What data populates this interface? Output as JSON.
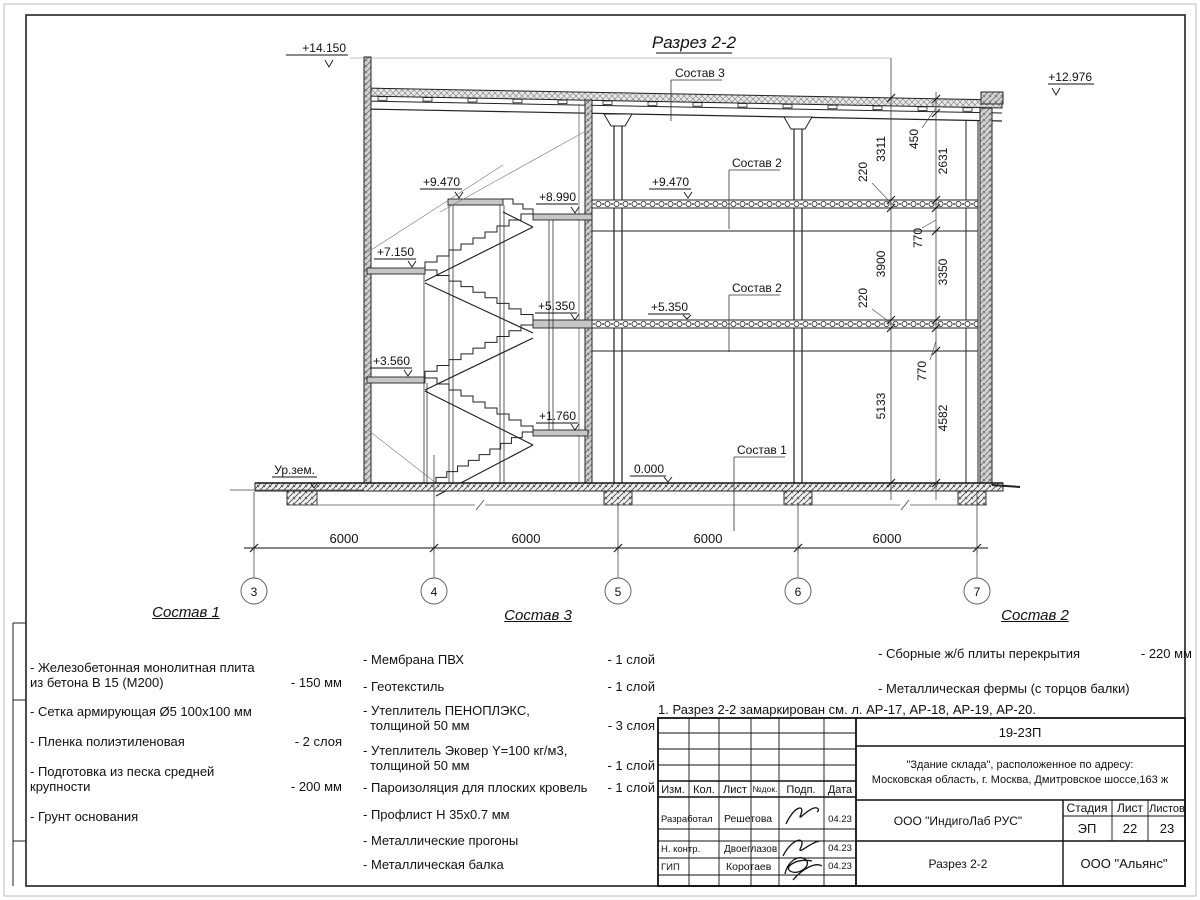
{
  "drawing": {
    "title": "Разрез 2-2",
    "callout_roof": "Состав 3",
    "callout_floor_upper": "Состав 2",
    "callout_floor_lower": "Состав 2",
    "callout_slab": "Состав 1",
    "elev_top_left": "+14.150",
    "elev_top_right": "+12.976",
    "elev_stair_1": "+9.470",
    "elev_stair_2": "+8.990",
    "elev_stair_3": "+7.150",
    "elev_stair_4": "+5.350",
    "elev_stair_5": "+3.560",
    "elev_stair_6": "+1.760",
    "elev_hall_upper": "+9.470",
    "elev_hall_lower": "+5.350",
    "elev_zero": "0.000",
    "elev_ground": "Ур.зем."
  },
  "dims": {
    "inner": [
      "3311",
      "220",
      "3900",
      "220",
      "5133"
    ],
    "outer": [
      "450",
      "2631",
      "770",
      "3350",
      "770",
      "4582"
    ],
    "bottom": [
      "6000",
      "6000",
      "6000",
      "6000"
    ],
    "axes": [
      "3",
      "4",
      "5",
      "6",
      "7"
    ]
  },
  "legends": {
    "c1": {
      "title": "Состав 1",
      "items": [
        {
          "l1": "- Железобетонная  монолитная плита",
          "l2": "из бетона В 15 (М200)",
          "v": "- 150 мм"
        },
        {
          "l1": "- Сетка армирующая Ø5 100x100 мм",
          "l2": "",
          "v": ""
        },
        {
          "l1": "- Пленка полиэтиленовая",
          "l2": "",
          "v": "- 2 слоя"
        },
        {
          "l1": "- Подготовка из песка средней",
          "l2": "крупности",
          "v": "- 200 мм"
        },
        {
          "l1": "- Грунт основания",
          "l2": "",
          "v": ""
        }
      ]
    },
    "c3": {
      "title": "Состав 3",
      "items": [
        {
          "l1": "- Мембрана ПВХ",
          "l2": "",
          "v": "- 1 слой"
        },
        {
          "l1": "- Геотекстиль",
          "l2": "",
          "v": "- 1 слой"
        },
        {
          "l1": "- Утеплитель ПЕНОПЛЭКС,",
          "l2": "толщиной 50 мм",
          "v": "- 3 слоя"
        },
        {
          "l1": "- Утеплитель Эковер Y=100 кг/м3,",
          "l2": "толщиной 50 мм",
          "v": "- 1 слой"
        },
        {
          "l1": "- Пароизоляция для плоских кровель",
          "l2": "",
          "v": "- 1 слой"
        },
        {
          "l1": "- Профлист Н 35х0.7 мм",
          "l2": "",
          "v": ""
        },
        {
          "l1": "- Металлические прогоны",
          "l2": "",
          "v": ""
        },
        {
          "l1": "- Металлическая балка",
          "l2": "",
          "v": ""
        }
      ]
    },
    "c2": {
      "title": "Состав 2",
      "items": [
        {
          "l1": "- Сборные ж/б плиты перекрытия",
          "l2": "",
          "v": "- 220 мм"
        },
        {
          "l1": "- Металлическая фермы (с торцов балки)",
          "l2": "",
          "v": ""
        }
      ]
    }
  },
  "note": "1. Разрез 2-2 замаркирован см. л. АР-17, АР-18, АР-19, АР-20.",
  "titleblock": {
    "code": "19-23П",
    "object_l1": "\"Здание склада\", расположенное по адресу:",
    "object_l2": "Московская область, г. Москва, Дмитровское шоссе,163 ж",
    "col_izm": "Изм.",
    "col_kol": "Кол.",
    "col_list": "Лист",
    "col_ndok": "№док.",
    "col_podp": "Подп.",
    "col_data": "Дата",
    "rows": [
      {
        "role": "Разработал",
        "name": "Решетова",
        "date": "04.23"
      },
      {
        "role": "Н. контр.",
        "name": "Двоеглазов",
        "date": "04.23"
      },
      {
        "role": "ГИП",
        "name": "Коротаев",
        "date": "04.23"
      }
    ],
    "org": "ООО \"ИндигоЛаб РУС\"",
    "stage_h": "Стадия",
    "sheet_h": "Лист",
    "sheets_h": "Листов",
    "stage": "ЭП",
    "sheet": "22",
    "sheets": "23",
    "drawing_name": "Разрез 2-2",
    "company": "ООО \"Альянс\""
  }
}
